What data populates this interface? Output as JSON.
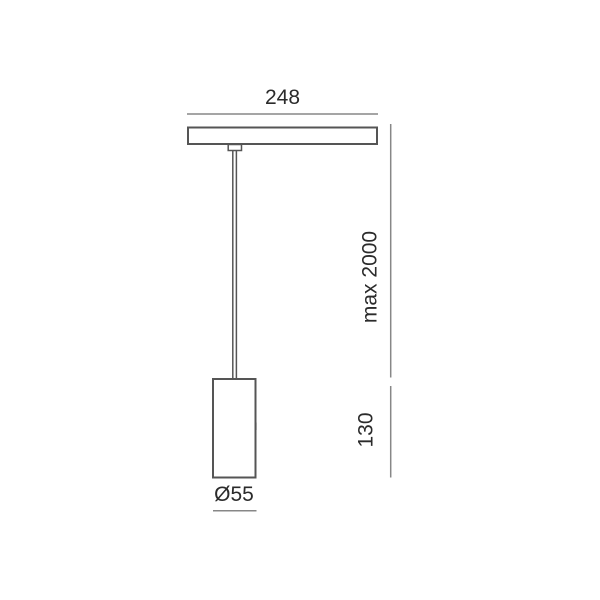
{
  "drawing": {
    "title": "Pendant luminaire dimension drawing",
    "labels": {
      "track_width": "248",
      "max_suspension": "max 2000",
      "body_height": "130",
      "body_diameter": "Ø55"
    },
    "colors": {
      "object_line": "#555555",
      "dimension_line": "#878787",
      "label_text": "#2b2b2b",
      "background": "#ffffff"
    }
  }
}
